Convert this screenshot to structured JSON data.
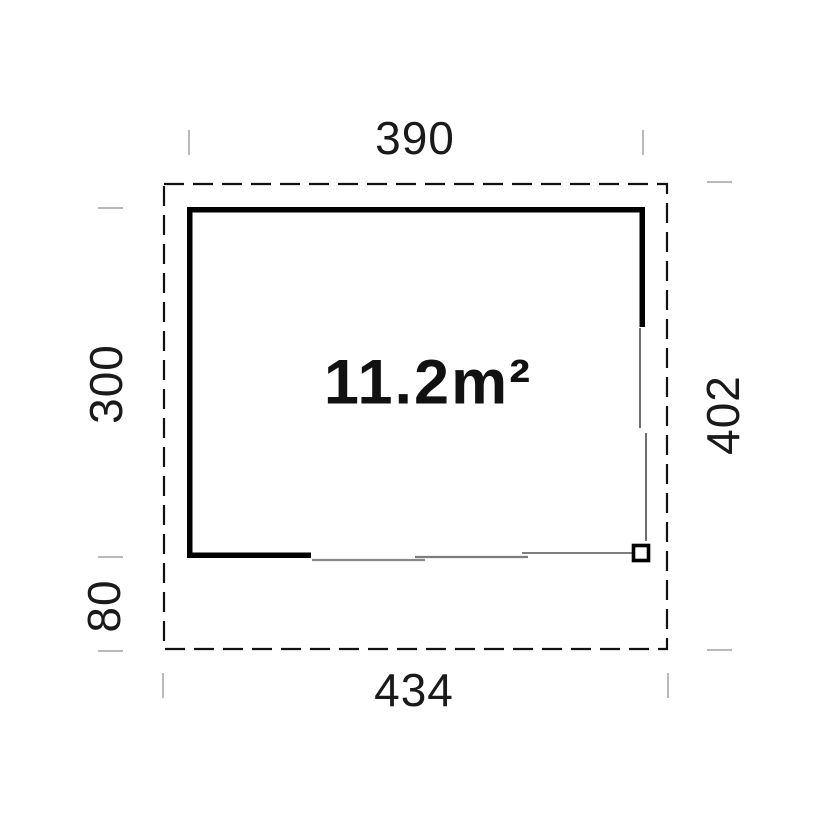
{
  "floor_plan": {
    "area_label": "11.2m²",
    "dimensions": {
      "top_width": "390",
      "left_height": "300",
      "left_offset": "80",
      "right_height": "402",
      "bottom_width": "434"
    },
    "colors": {
      "wall": "#000000",
      "dashed_outline": "#111111",
      "door_line_gray": "#7d7d7d",
      "door_line_dark": "#4a4a4a",
      "tick": "#b9b9b9",
      "label_text": "#1a1a1a",
      "background": "#ffffff"
    }
  }
}
